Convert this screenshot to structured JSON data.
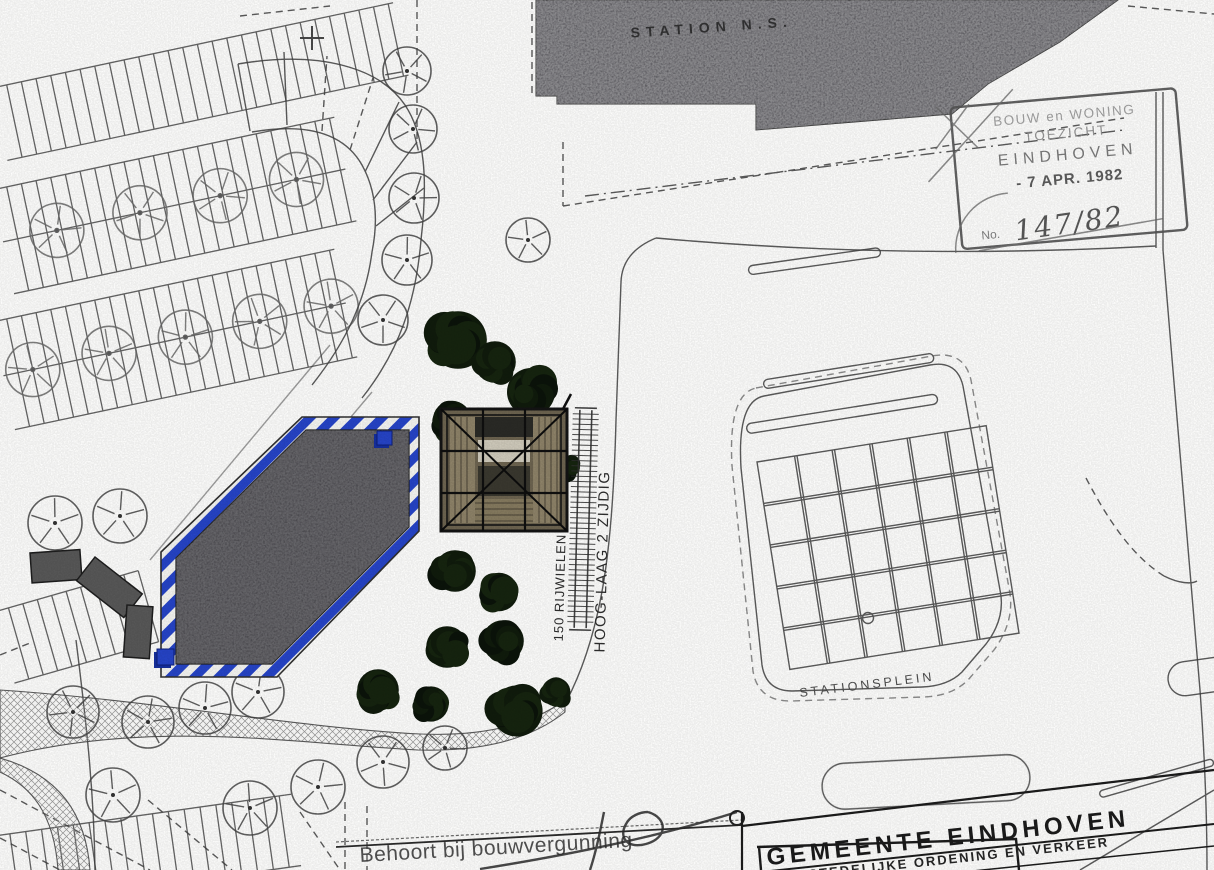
{
  "colors": {
    "accent_blue": "#2644c7",
    "accent_blue_dark": "#162f9e",
    "asphalt": "#4e4d52",
    "station_gray": "#636267",
    "foliage": "#101b0c",
    "ink": "#3f3f3f"
  },
  "labels": {
    "station": "STATION N.S.",
    "stationsplein": "STATIONSPLEIN",
    "bike_rack_count": "150 RIJWIELEN",
    "bike_rack_type": "HOOG-LAAG 2 ZIJDIG",
    "permit_note": "Behoort bij bouwvergunning",
    "municipality": "GEMEENTE  EINDHOVEN",
    "department": "STEDELIJKE ORDENING EN VERKEER"
  },
  "stamp": {
    "line1": "BOUW en WONING",
    "line2": "TOEZICHT",
    "line3": "EINDHOVEN",
    "date": "- 7 APR. 1982",
    "no_label": "No.",
    "number": "147/82"
  }
}
